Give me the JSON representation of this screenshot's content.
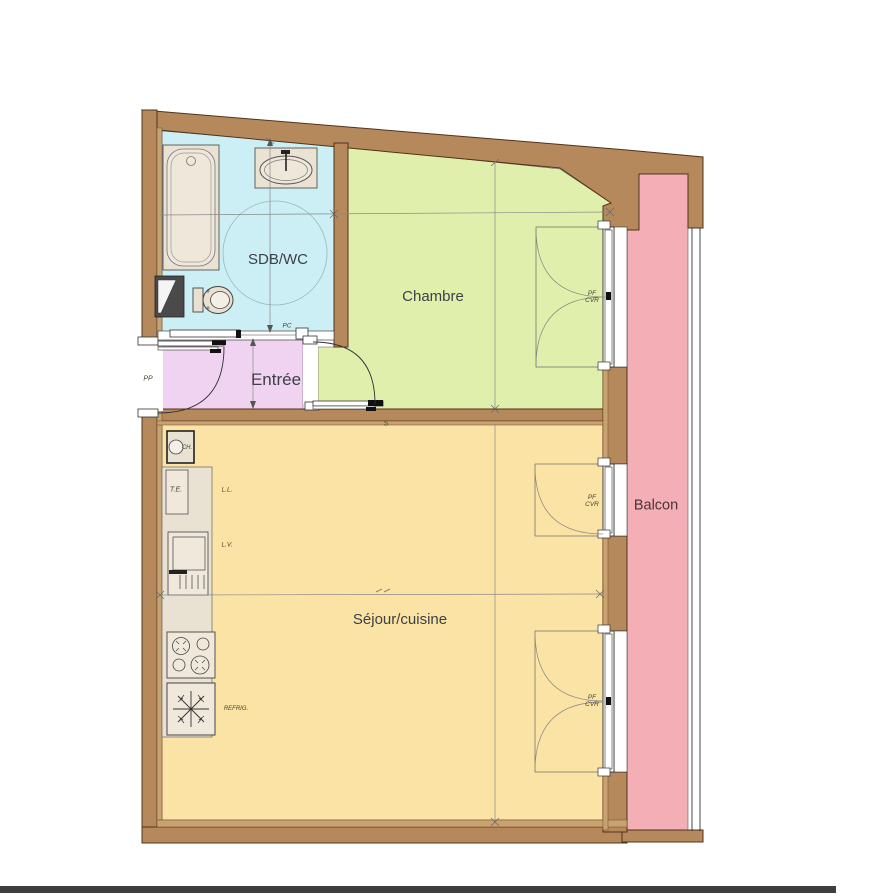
{
  "floorplan": {
    "rooms": {
      "sdb": "SDB/WC",
      "chambre": "Chambre",
      "entree": "Entrée",
      "sejour": "Séjour/cuisine",
      "balcon": "Balcon"
    },
    "doors": {
      "front": "PP",
      "sliding": "PC",
      "s_mark": "S"
    },
    "window": {
      "line1": "PF",
      "line2": "CVR"
    },
    "kitchen": {
      "water_heater": "CH.",
      "electrical_panel": "T.E.",
      "washing_machine": "L.L.",
      "dishwasher": "L.V.",
      "fridge": "REFRIG."
    },
    "colors": {
      "wall": "#b5895c",
      "wall_liner": "#c9a271",
      "sdb": "#cbeff4",
      "chambre": "#e1efad",
      "entree": "#f0d3f1",
      "sejour": "#fae3a4",
      "balcon": "#f3afb5",
      "fixture": "#eae2d3"
    }
  }
}
